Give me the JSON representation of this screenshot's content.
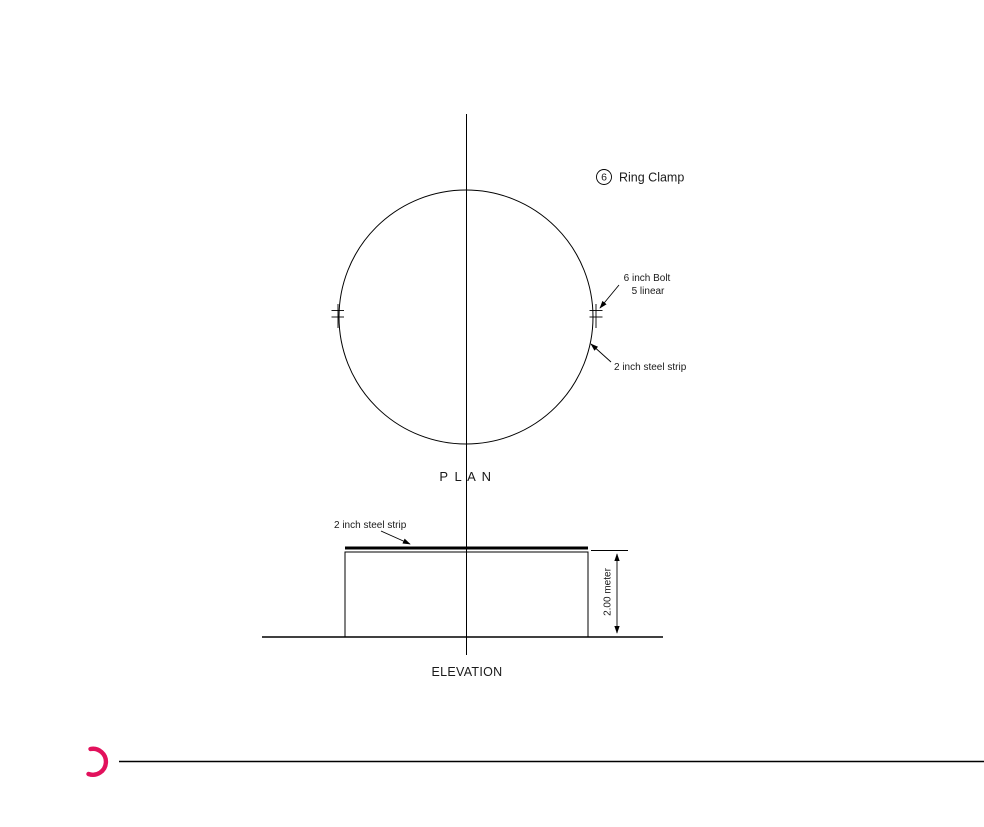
{
  "title": {
    "badge_number": "6",
    "label": "Ring Clamp"
  },
  "plan": {
    "caption": "P L A N",
    "bolt_annotation": {
      "line1": "6 inch Bolt",
      "line2": "5 linear"
    },
    "strip_annotation": "2 inch steel strip"
  },
  "elevation": {
    "caption": "ELEVATION",
    "strip_annotation": "2 inch steel strip",
    "height_dimension": {
      "value": "2.00",
      "unit": "meter",
      "label": "2.00 meter"
    }
  },
  "colors": {
    "line": "#000000",
    "accent_arc": "#e2115c",
    "background": "#ffffff"
  }
}
